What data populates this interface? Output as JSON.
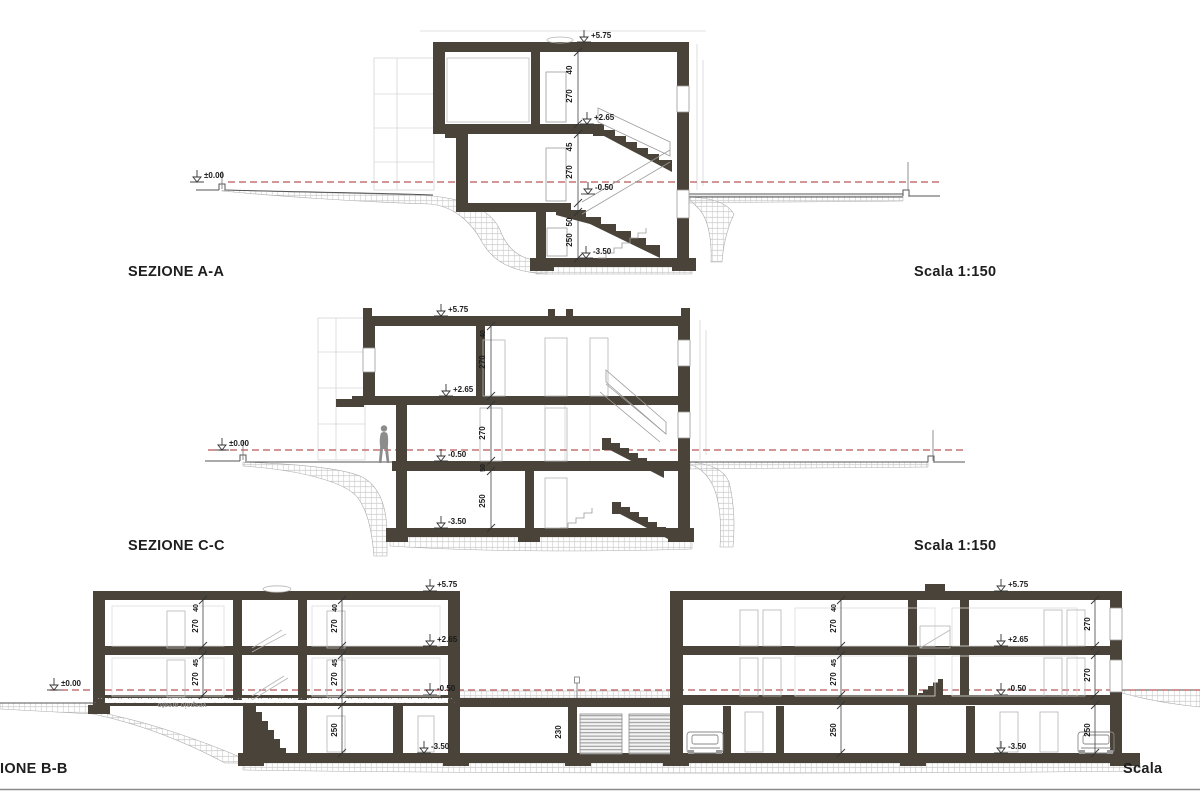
{
  "colors": {
    "wall": "#494339",
    "line": "#555555",
    "thin": "#8a8a8a",
    "faint": "#d2d2d2",
    "red_dash": "#b95757",
    "text": "#1a1a1a",
    "figure": "#8c8c8c"
  },
  "sections": [
    {
      "label": "SEZIONE A-A",
      "scale": "Scala 1:150"
    },
    {
      "label": "SEZIONE C-C",
      "scale": "Scala 1:150"
    },
    {
      "label": "IONE B-B",
      "scale": "Scala"
    }
  ],
  "annotations": {
    "aa": [
      {
        "t": "+5.75",
        "x": 591,
        "y": 38,
        "n": "level-label"
      },
      {
        "t": "+2.65",
        "x": 594,
        "y": 120,
        "n": "level-label"
      },
      {
        "t": "-0.50",
        "x": 595,
        "y": 190,
        "n": "level-label"
      },
      {
        "t": "-3.50",
        "x": 593,
        "y": 254,
        "n": "level-label"
      },
      {
        "t": "±0.00",
        "x": 204,
        "y": 178,
        "n": "level-label"
      },
      {
        "t": "40",
        "x": 572,
        "y": 70,
        "r": -90,
        "n": "dim-label"
      },
      {
        "t": "270",
        "x": 572,
        "y": 96,
        "r": -90,
        "n": "dim-label"
      },
      {
        "t": "45",
        "x": 572,
        "y": 147,
        "r": -90,
        "n": "dim-label"
      },
      {
        "t": "270",
        "x": 572,
        "y": 172,
        "r": -90,
        "n": "dim-label"
      },
      {
        "t": "50",
        "x": 572,
        "y": 222,
        "r": -90,
        "n": "dim-label"
      },
      {
        "t": "250",
        "x": 572,
        "y": 240,
        "r": -90,
        "n": "dim-label"
      }
    ],
    "cc": [
      {
        "t": "+5.75",
        "x": 448,
        "y": 312,
        "n": "level-label"
      },
      {
        "t": "+2.65",
        "x": 453,
        "y": 392,
        "n": "level-label"
      },
      {
        "t": "-0.50",
        "x": 448,
        "y": 457,
        "n": "level-label"
      },
      {
        "t": "-3.50",
        "x": 448,
        "y": 524,
        "n": "level-label"
      },
      {
        "t": "±0.00",
        "x": 229,
        "y": 446,
        "n": "level-label"
      },
      {
        "t": "40",
        "x": 485,
        "y": 334,
        "r": -90,
        "s": 7,
        "n": "dim-label"
      },
      {
        "t": "270",
        "x": 485,
        "y": 362,
        "r": -90,
        "n": "dim-label"
      },
      {
        "t": "270",
        "x": 485,
        "y": 433,
        "r": -90,
        "n": "dim-label"
      },
      {
        "t": "50",
        "x": 485,
        "y": 468,
        "r": -90,
        "s": 7,
        "n": "dim-label"
      },
      {
        "t": "250",
        "x": 485,
        "y": 501,
        "r": -90,
        "n": "dim-label"
      }
    ],
    "bb": [
      {
        "t": "±0.00",
        "x": 61,
        "y": 686,
        "n": "level-label"
      },
      {
        "t": "+5.75",
        "x": 437,
        "y": 587,
        "n": "level-label"
      },
      {
        "t": "+2.65",
        "x": 437,
        "y": 642,
        "n": "level-label"
      },
      {
        "t": "-0.50",
        "x": 437,
        "y": 691,
        "n": "level-label"
      },
      {
        "t": "-3.50",
        "x": 431,
        "y": 749,
        "n": "level-label"
      },
      {
        "t": "+5.75",
        "x": 1008,
        "y": 587,
        "n": "level-label"
      },
      {
        "t": "+2.65",
        "x": 1008,
        "y": 642,
        "n": "level-label"
      },
      {
        "t": "-0.50",
        "x": 1008,
        "y": 691,
        "n": "level-label"
      },
      {
        "t": "-3.50",
        "x": 1008,
        "y": 749,
        "n": "level-label"
      },
      {
        "t": "40",
        "x": 198,
        "y": 608,
        "r": -90,
        "s": 7,
        "n": "dim-label"
      },
      {
        "t": "270",
        "x": 198,
        "y": 626,
        "r": -90,
        "n": "dim-label"
      },
      {
        "t": "45",
        "x": 198,
        "y": 663,
        "r": -90,
        "s": 7,
        "n": "dim-label"
      },
      {
        "t": "270",
        "x": 198,
        "y": 679,
        "r": -90,
        "n": "dim-label"
      },
      {
        "t": "40",
        "x": 337,
        "y": 608,
        "r": -90,
        "s": 7,
        "n": "dim-label"
      },
      {
        "t": "270",
        "x": 337,
        "y": 626,
        "r": -90,
        "n": "dim-label"
      },
      {
        "t": "45",
        "x": 337,
        "y": 663,
        "r": -90,
        "s": 7,
        "n": "dim-label"
      },
      {
        "t": "270",
        "x": 337,
        "y": 679,
        "r": -90,
        "n": "dim-label"
      },
      {
        "t": "250",
        "x": 337,
        "y": 730,
        "r": -90,
        "n": "dim-label"
      },
      {
        "t": "230",
        "x": 561,
        "y": 732,
        "r": -90,
        "n": "dim-label"
      },
      {
        "t": "40",
        "x": 836,
        "y": 608,
        "r": -90,
        "s": 7,
        "n": "dim-label"
      },
      {
        "t": "270",
        "x": 836,
        "y": 626,
        "r": -90,
        "n": "dim-label"
      },
      {
        "t": "45",
        "x": 836,
        "y": 663,
        "r": -90,
        "s": 7,
        "n": "dim-label"
      },
      {
        "t": "270",
        "x": 836,
        "y": 679,
        "r": -90,
        "n": "dim-label"
      },
      {
        "t": "250",
        "x": 836,
        "y": 730,
        "r": -90,
        "n": "dim-label"
      },
      {
        "t": "270",
        "x": 1090,
        "y": 624,
        "r": -90,
        "n": "dim-label"
      },
      {
        "t": "270",
        "x": 1090,
        "y": 675,
        "r": -90,
        "n": "dim-label"
      },
      {
        "t": "250",
        "x": 1090,
        "y": 730,
        "r": -90,
        "n": "dim-label"
      },
      {
        "t": "vespaio areato",
        "x": 182,
        "y": 703,
        "r": 180,
        "s": 7,
        "c": "#8d8d8d",
        "n": "vespaio-label"
      }
    ]
  }
}
